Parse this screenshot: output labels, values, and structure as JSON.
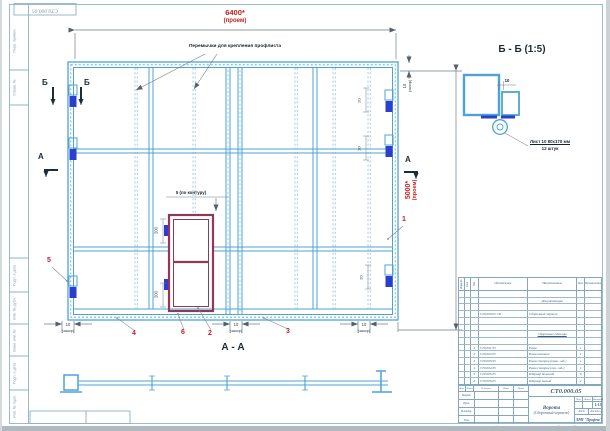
{
  "sheet": {
    "corner_designation": "СТ0.000.05",
    "margin_labels": {
      "perv_primen": "Перв. примен.",
      "sprav_no": "Справ. №",
      "podp_data_1": "Подп. и дата",
      "inv_dubl": "Инв. № дубл.",
      "vzam_inv": "Взам. инв. №",
      "podp_data_2": "Подп. и дата",
      "inv_podl": "Инв. № подл."
    },
    "footer": {
      "copied": "Копировал",
      "format": "Формат А3"
    }
  },
  "main_view": {
    "dim_width": "6400*",
    "dim_width_note": "(проем)",
    "dim_height": "5000*",
    "dim_height_note": "(проем)",
    "gap_value": "10",
    "gap_note": "(зазор)",
    "crossbar_annotation": "Перемычки для крепления профлиста",
    "door_contour_gap": "5 (по контуру)",
    "door_dim_top": "200",
    "door_dim_bottom": "200",
    "hinge_dim": "20",
    "section_b": "Б",
    "section_a": "А",
    "balloons": {
      "frame_stile": "1",
      "door_frame": "2",
      "right_rail": "3",
      "left_rail": "4",
      "hinge": "5",
      "door_leaf": "6"
    }
  },
  "detail_bb": {
    "title": "Б - Б (1:5)",
    "gap_dim": "10",
    "note_line1": "Лист 10   80х170 мм",
    "note_line2": "12 штук"
  },
  "section_aa": {
    "title": "А - А"
  },
  "spec": {
    "headers": {
      "format": "Формат",
      "zone": "Зона",
      "pos": "Поз.",
      "designation": "Обозначение",
      "name": "Наименование",
      "qty": "Кол.",
      "note": "Примечание"
    },
    "section_docs": "Документация",
    "doc_row": {
      "designation": "СТ0.000.05 СБ",
      "name": "Сборочный чертеж"
    },
    "section_units": "Сборочные единицы",
    "rows": [
      {
        "pos": "1",
        "designation": "СТ0.001.05",
        "name": "Рама",
        "qty": "1"
      },
      {
        "pos": "2",
        "designation": "СТ0.002.05",
        "name": "Рама калитки",
        "qty": "1"
      },
      {
        "pos": "3",
        "designation": "СТ0.003.05",
        "name": "Рама створки (прав. габ.)",
        "qty": "1"
      },
      {
        "pos": "4",
        "designation": "СТ0.004.05",
        "name": "Рама створки (лев. габ.)",
        "qty": "1"
      },
      {
        "pos": "5",
        "designation": "СТ0.005.05",
        "name": "Шарнир большой",
        "qty": "6"
      },
      {
        "pos": "6",
        "designation": "СТ0.006.05",
        "name": "Шарнир малый",
        "qty": "2"
      }
    ]
  },
  "title_block": {
    "designation": "СТ0.000.05",
    "product_name": "Ворота",
    "doc_type": "(Сборочный чертеж)",
    "sig_header": {
      "izm": "Изм.",
      "list": "Лист",
      "doc": "№ докум.",
      "podp": "Подп.",
      "data": "Дата"
    },
    "sig_rows": {
      "razrab": "Разраб.",
      "prov": "Пров.",
      "nkontr": "Н.контр.",
      "utv": "Утв."
    },
    "lit": "Лит.",
    "mass": "Масса",
    "scale_label": "Масштаб",
    "scale": "1:15",
    "sheet_label": "Лист",
    "sheets_label": "Листов",
    "sheets_value": "1",
    "company": "ЛРМ \"Профекс\""
  },
  "colors": {
    "line_blue": "#4da3d6",
    "hinge_blue": "#2b3ed2",
    "door_maroon": "#8e3a56",
    "dim_red": "#c51d1d"
  }
}
